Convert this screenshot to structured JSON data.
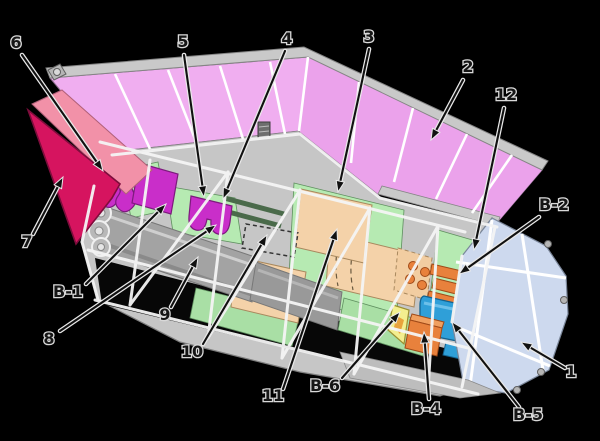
{
  "figure": {
    "kind": "spacecraft cutaway schematic",
    "description": "Exploded cutaway diagram of a winged spacecraft/satellite with numbered component callouts and B-series equipment callouts",
    "background_color": "#000000"
  },
  "colors": {
    "solar_array_pink": "#f0aef0",
    "solar_array_pink_dark": "#e79ce7",
    "fin_crimson": "#d6145f",
    "fin_pink_band": "#f291a8",
    "frame_gray": "#c6c6c6",
    "barrel_gray": "#a3a3a3",
    "panel_green": "#b6eab2",
    "box_peach": "#f4d2a9",
    "instrument_magenta": "#c92ec9",
    "component_orange": "#e8813c",
    "component_blue": "#2f9fd8",
    "component_yellow": "#f3ee8f",
    "aft_panel_blue": "#cdd9ee",
    "strut_white": "#f5f5f5",
    "label_ink": "#161616",
    "label_halo": "#d9d9d9"
  },
  "callouts": [
    {
      "id": "1",
      "text": "1",
      "lx": 571,
      "ly": 377,
      "ax": 565,
      "ay": 368,
      "tx": 521,
      "ty": 342
    },
    {
      "id": "2",
      "text": "2",
      "lx": 468,
      "ly": 72,
      "ax": 463,
      "ay": 80,
      "tx": 431,
      "ty": 140
    },
    {
      "id": "3",
      "text": "3",
      "lx": 369,
      "ly": 42,
      "ax": 369,
      "ay": 49,
      "tx": 338,
      "ty": 192
    },
    {
      "id": "4",
      "text": "4",
      "lx": 287,
      "ly": 44,
      "ax": 285,
      "ay": 51,
      "tx": 223,
      "ty": 199
    },
    {
      "id": "5",
      "text": "5",
      "lx": 183,
      "ly": 47,
      "ax": 184,
      "ay": 55,
      "tx": 204,
      "ty": 197
    },
    {
      "id": "6",
      "text": "6",
      "lx": 16,
      "ly": 48,
      "ax": 22,
      "ay": 55,
      "tx": 103,
      "ty": 171
    },
    {
      "id": "7",
      "text": "7",
      "lx": 27,
      "ly": 247,
      "ax": 33,
      "ay": 234,
      "tx": 63,
      "ty": 177
    },
    {
      "id": "8",
      "text": "8",
      "lx": 49,
      "ly": 344,
      "ax": 60,
      "ay": 331,
      "tx": 216,
      "ty": 225
    },
    {
      "id": "9",
      "text": "9",
      "lx": 165,
      "ly": 320,
      "ax": 171,
      "ay": 307,
      "tx": 198,
      "ty": 257
    },
    {
      "id": "10",
      "text": "10",
      "lx": 192,
      "ly": 357,
      "ax": 203,
      "ay": 344,
      "tx": 267,
      "ty": 235
    },
    {
      "id": "11",
      "text": "11",
      "lx": 273,
      "ly": 401,
      "ax": 283,
      "ay": 389,
      "tx": 337,
      "ty": 229
    },
    {
      "id": "12",
      "text": "12",
      "lx": 506,
      "ly": 100,
      "ax": 504,
      "ay": 108,
      "tx": 474,
      "ty": 250
    },
    {
      "id": "B-1",
      "text": "B-1",
      "lx": 68,
      "ly": 297,
      "ax": 86,
      "ay": 284,
      "tx": 166,
      "ty": 204
    },
    {
      "id": "B-2",
      "text": "B-2",
      "lx": 554,
      "ly": 210,
      "ax": 539,
      "ay": 217,
      "tx": 459,
      "ty": 274
    },
    {
      "id": "B-4",
      "text": "B-4",
      "lx": 426,
      "ly": 414,
      "ax": 429,
      "ay": 399,
      "tx": 424,
      "ty": 332
    },
    {
      "id": "B-5",
      "text": "B-5",
      "lx": 528,
      "ly": 420,
      "ax": 519,
      "ay": 407,
      "tx": 452,
      "ty": 322
    },
    {
      "id": "B-6",
      "text": "B-6",
      "lx": 325,
      "ly": 391,
      "ax": 342,
      "ay": 378,
      "tx": 400,
      "ty": 312
    }
  ]
}
